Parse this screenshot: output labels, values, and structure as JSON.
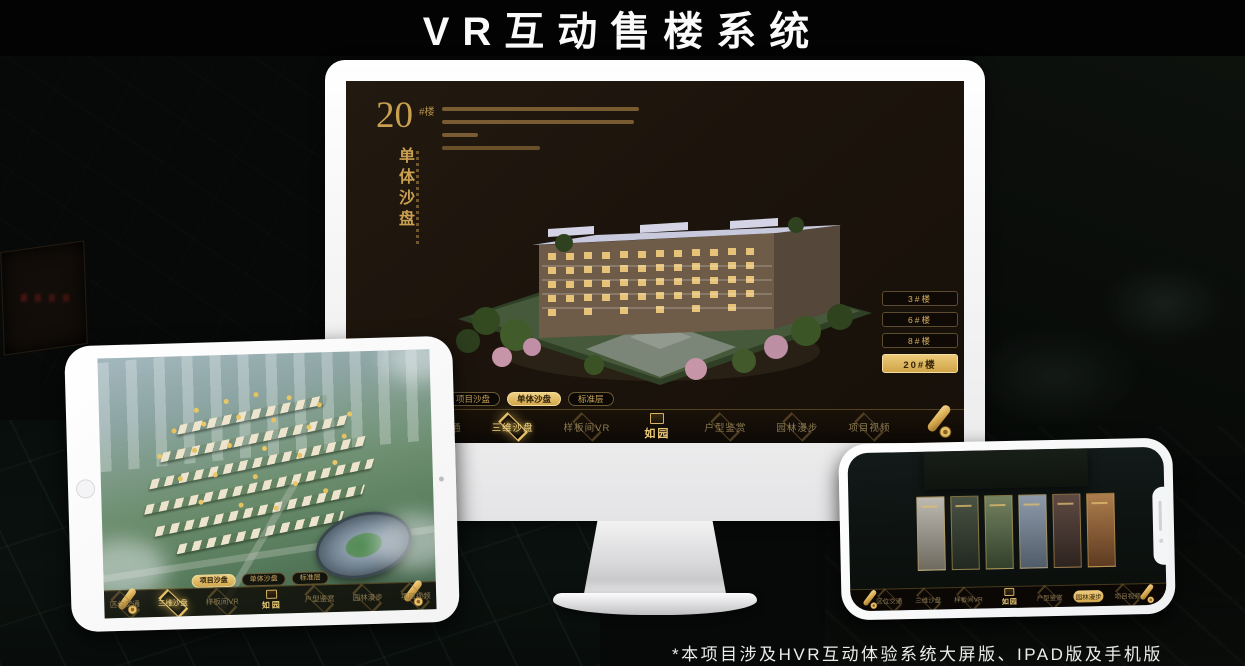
{
  "page": {
    "title": "VR互动售楼系统",
    "footnote": "*本项目涉及HVR互动体验系统大屏版、IPAD版及手机版"
  },
  "monitor": {
    "screen_title": {
      "number": "20",
      "suffix": "#楼",
      "vertical": "单体沙盘"
    },
    "floor_buttons": [
      "3#楼",
      "6#楼",
      "8#楼",
      "20#楼"
    ],
    "selected_floor": "20#楼",
    "sub_tabs": [
      "项目沙盘",
      "单体沙盘",
      "标准层"
    ],
    "selected_sub_tab": "单体沙盘",
    "nav_items": [
      "区位交通",
      "三维沙盘",
      "样板间VR",
      "户型鉴赏",
      "园林漫步",
      "项目视频"
    ],
    "selected_nav": "三维沙盘",
    "logo": "如园"
  },
  "ipad": {
    "sub_tabs": [
      "项目沙盘",
      "单体沙盘",
      "标准层"
    ],
    "selected_sub_tab": "项目沙盘",
    "nav_items": [
      "区位交通",
      "三维沙盘",
      "样板间VR",
      "户型鉴赏",
      "园林漫步",
      "项目视频"
    ],
    "selected_nav": "三维沙盘",
    "logo": "如园"
  },
  "phone": {
    "nav_items": [
      "区位交通",
      "三维沙盘",
      "样板间VR",
      "户型鉴赏",
      "园林漫步",
      "项目视频"
    ],
    "selected_nav": "园林漫步",
    "logo": "如园"
  },
  "colors": {
    "gold": "#d2ab5d",
    "gold_bright": "#ecc779",
    "selected_text": "#2e2009"
  }
}
